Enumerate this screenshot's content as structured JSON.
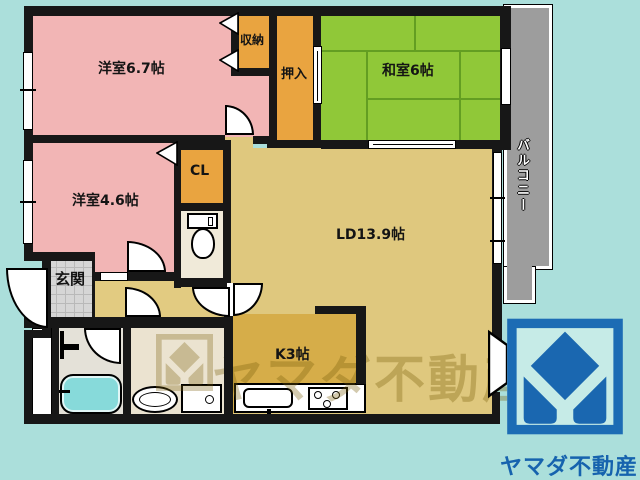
{
  "labels": {
    "room_67": "洋室6.7帖",
    "room_46": "洋室4.6帖",
    "washitsu": "和室6帖",
    "shuno": "収納",
    "oshiire": "押入",
    "cl": "CL",
    "genkan": "玄関",
    "ld": "LD13.9帖",
    "kitchen": "K3帖",
    "balcony": "バルコニー"
  },
  "branding": {
    "company": "ヤマダ不動産",
    "watermark_text": "ヤマダ不動産",
    "logo_blue": "#1c6cb4",
    "logo_caption_blue": "#1663ae"
  },
  "colors": {
    "background_teal": "#abdfdb",
    "western_room_pink": "#f2b5b5",
    "closet_orange": "#e9a440",
    "tatami_green": "#90c838",
    "living_tan": "#dfc87e",
    "kitchen_mustard": "#d6ad49",
    "toilet_cream": "#f0ead9",
    "washroom_cream": "#ebe3d0",
    "bath_gray": "#e4e1d8",
    "bathtub_cyan": "#87dada",
    "balcony_gray": "#9d9d9d",
    "wall_black": "#171717"
  }
}
